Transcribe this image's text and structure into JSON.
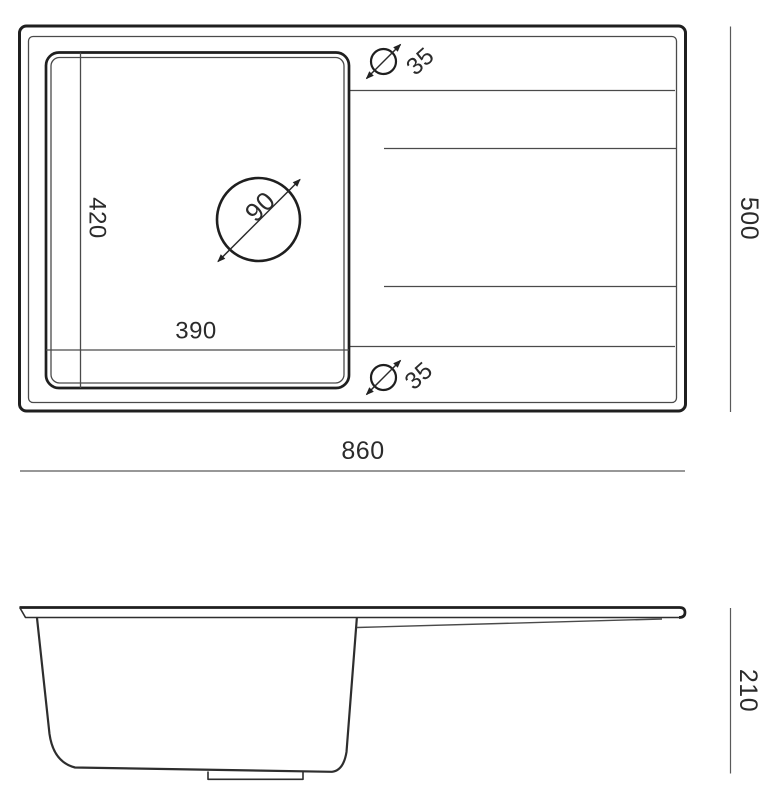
{
  "drawing": {
    "views": {
      "top": {
        "overall_width": "860",
        "overall_depth": "500",
        "bowl_width": "390",
        "bowl_depth": "420",
        "drain_hole_diameter": "90",
        "tap_hole_top_diameter": "35",
        "tap_hole_bottom_diameter": "35"
      },
      "side": {
        "overall_height": "210"
      }
    },
    "colors": {
      "line_strong": "#1f1f1f",
      "line_medium": "#2e2e2e",
      "line_light": "#4a4a4a",
      "dimension_line": "#5a5a5a",
      "text": "#2b2b2b",
      "background": "#ffffff"
    }
  }
}
